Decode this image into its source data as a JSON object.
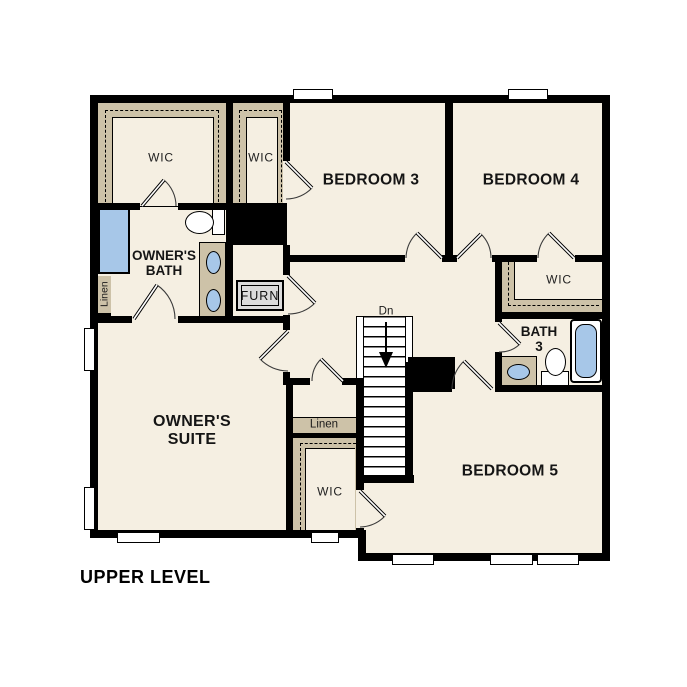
{
  "title": "UPPER LEVEL",
  "rooms": {
    "owners_wic": {
      "label": "WIC"
    },
    "bed3_wic": {
      "label": "WIC"
    },
    "bedroom3": {
      "label": "BEDROOM 3"
    },
    "bedroom4": {
      "label": "BEDROOM 4"
    },
    "owners_bath": {
      "line1": "OWNER'S",
      "line2": "BATH"
    },
    "linen_left": {
      "label": "Linen"
    },
    "furnace": {
      "label": "FURN"
    },
    "bed4_wic": {
      "label": "WIC"
    },
    "bath3": {
      "line1": "BATH",
      "line2": "3"
    },
    "owners_suite": {
      "line1": "OWNER'S",
      "line2": "SUITE"
    },
    "linen_center": {
      "label": "Linen"
    },
    "bed5_wic": {
      "label": "WIC"
    },
    "bedroom5": {
      "label": "BEDROOM 5"
    },
    "stairs": {
      "direction_label": "Dn"
    }
  },
  "fixtures": {
    "owners_bath": [
      "shower",
      "toilet",
      "double-vanity-sinks"
    ],
    "bath3": [
      "sink-vanity",
      "toilet",
      "bathtub"
    ],
    "utility": [
      "furnace"
    ],
    "stairs": "staircase-down"
  },
  "colors": {
    "floor": "#f5efe2",
    "closet_shelf": "#cdc2a8",
    "fixture_blue": "#a7c7e8",
    "wall": "#000000",
    "furnace_fill": "#dcdcdc"
  }
}
